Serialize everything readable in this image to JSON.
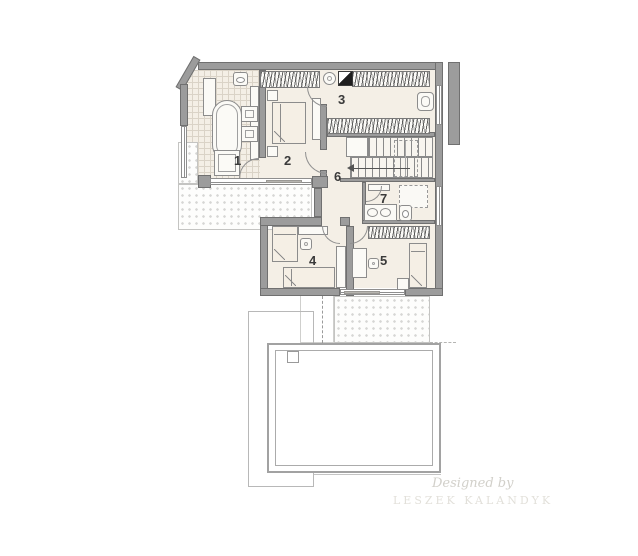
{
  "rooms": [
    {
      "number": "1"
    },
    {
      "number": "2"
    },
    {
      "number": "3"
    },
    {
      "number": "4"
    },
    {
      "number": "5"
    },
    {
      "number": "6"
    },
    {
      "number": "7"
    }
  ],
  "watermark": {
    "line1": "Designed by",
    "line2": "LESZEK KALANDYK"
  },
  "fixtures": [
    "bathtub",
    "shower",
    "washbasin",
    "toilet",
    "double-bed",
    "single-bed",
    "desk",
    "chair",
    "wardrobe-rail",
    "staircase",
    "radiator",
    "armchair",
    "washing-machine",
    "fireplace-flue",
    "balcony",
    "terrace",
    "roof-outline",
    "chimney"
  ],
  "colors": {
    "wall": "#9c9c9c",
    "wall_outline": "#707070",
    "floor": "#f4efe6",
    "tile_line": "#d9d2c6",
    "fixture_line": "#8c8c8c",
    "label": "#3a3a3a",
    "accent_dark": "#1f1f1f",
    "dot": "#d6d6d4",
    "watermark_script": "#d2d0ca",
    "watermark_caps": "#e2e0da"
  }
}
